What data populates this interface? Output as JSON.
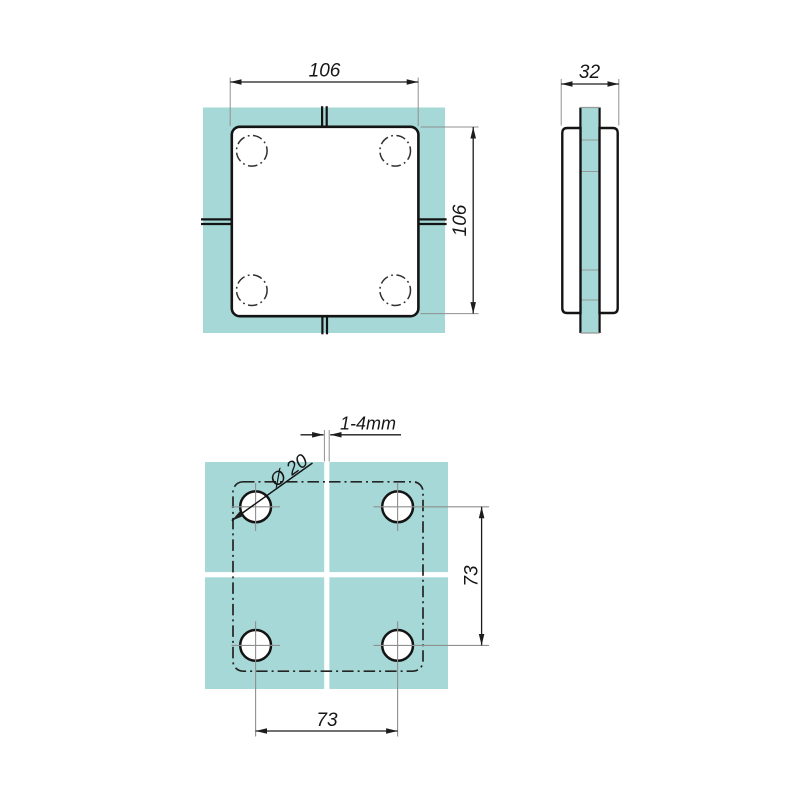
{
  "drawing": {
    "background": "#ffffff",
    "glass_color": "#a5d8d6",
    "line_color": "#141414",
    "thin_line_color": "#909090",
    "labels": {
      "plan_width": "106",
      "plan_height": "106",
      "side_thickness": "32",
      "glass_gap": "1-4mm",
      "hole_diameter": "Ø 20",
      "hole_spacing_vertical": "73",
      "hole_spacing_horizontal": "73"
    }
  }
}
